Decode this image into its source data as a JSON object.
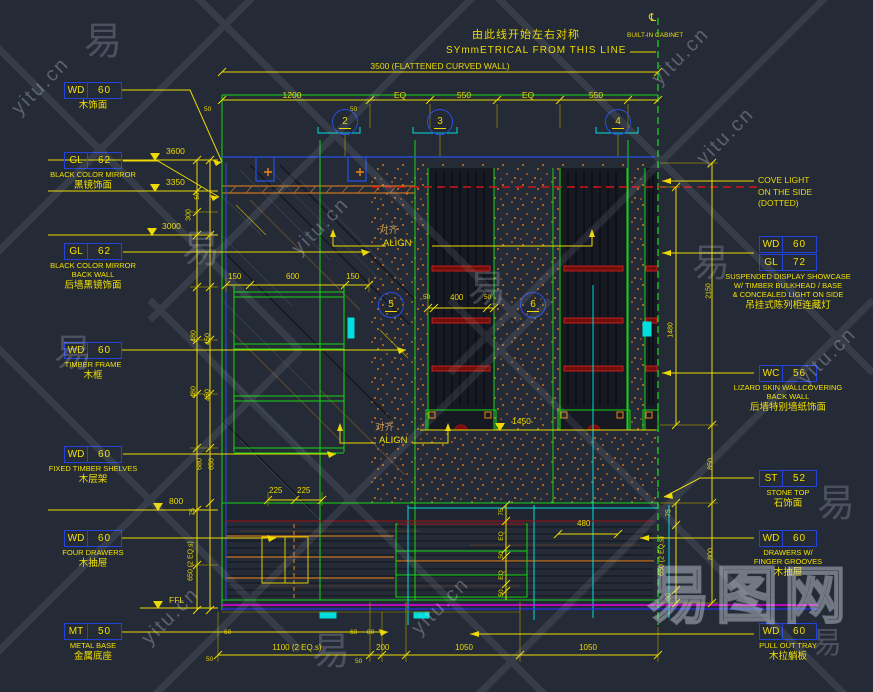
{
  "watermark": {
    "site": "yitu.cn",
    "brand": "易图网",
    "char": "易"
  },
  "header": {
    "title_cn": "由此线开始左右对称",
    "title_en": "SYmmETRICAL FROM THIS LINE",
    "corner_label": "BUILT-IN CABINET",
    "centerline_symbol": "℄",
    "overall_dim": "3500 (FLATTENED CURVED WALL)"
  },
  "bubbles": {
    "b2": "2",
    "b3": "3",
    "b4": "4",
    "b5": "5",
    "b6": "6"
  },
  "align": {
    "cn": "对齐",
    "en": "ALIGN"
  },
  "levels": {
    "l3600": "3600",
    "l3350": "3350",
    "l3000": "3000",
    "l1450": "1450",
    "l800": "800",
    "ffl": "FFL"
  },
  "dims": {
    "top": {
      "d1200": "1200",
      "eq1": "EQ",
      "d550a": "550",
      "eq2": "EQ",
      "d550b": "550",
      "d50a": "50",
      "d50b": "50"
    },
    "left": {
      "d50": "50",
      "d300": "300",
      "d480a": "480",
      "d450a": "450",
      "d480b": "480",
      "d450b": "450",
      "d680": "680",
      "d650": "650",
      "d75": "75",
      "d650eq": "650 (2 EQ.s)"
    },
    "right": {
      "d2150": "2150",
      "d1480": "1480",
      "d850": "850",
      "d800": "800",
      "d75": "75",
      "d650eq": "650 (2 EQ.s)",
      "d60": "60"
    },
    "inner": {
      "d150a": "150",
      "d600": "600",
      "d150b": "150",
      "d50a": "50",
      "d400": "400",
      "d50b": "50",
      "d225a": "225",
      "d225b": "225",
      "d480": "480",
      "d75": "75",
      "eq1": "EQ",
      "d50c": "50",
      "eq2": "EQ",
      "d50d": "50"
    },
    "bottom": {
      "d50a": "50",
      "d60a": "60",
      "d1100": "1100 (2 EQ.s)",
      "d60b": "60",
      "d80": "80",
      "d50b": "50",
      "d200": "200",
      "d1050a": "1050",
      "d1050b": "1050"
    }
  },
  "callouts_left": [
    {
      "code": "WD",
      "num": "60",
      "lines": [],
      "cn": "木饰面"
    },
    {
      "code": "GL",
      "num": "62",
      "lines": [
        "BLACK COLOR MIRROR"
      ],
      "cn": "黑镜饰面"
    },
    {
      "code": "GL",
      "num": "62",
      "lines": [
        "BLACK COLOR MIRROR",
        "BACK WALL"
      ],
      "cn": "后墙黑镜饰面"
    },
    {
      "code": "WD",
      "num": "60",
      "lines": [
        "TIMBER FRAME"
      ],
      "cn": "木框"
    },
    {
      "code": "WD",
      "num": "60",
      "lines": [
        "FIXED TIMBER SHELVES"
      ],
      "cn": "木层架"
    },
    {
      "code": "WD",
      "num": "60",
      "lines": [
        "FOUR DRAWERS"
      ],
      "cn": "木抽屉"
    },
    {
      "code": "MT",
      "num": "50",
      "lines": [
        "METAL BASE"
      ],
      "cn": "金属底座"
    }
  ],
  "callouts_right": {
    "cove": {
      "line1": "COVE LIGHT",
      "line2": "ON THE SIDE",
      "line3": "(DOTTED)"
    },
    "showcase": {
      "rows": [
        {
          "code": "WD",
          "num": "60"
        },
        {
          "code": "GL",
          "num": "72"
        }
      ],
      "line1": "SUSPENDED DISPLAY SHOWCASE",
      "line2": "W/ TIMBER BULKHEAD / BASE",
      "line3": "& CONCEALED LIGHT ON SIDE",
      "cn": "吊挂式陈列柜连藏灯"
    },
    "wallcovering": {
      "code": "WC",
      "num": "56",
      "line1": "LIZARD SKIN WALLCOVERING",
      "line2": "BACK WALL",
      "cn": "后墙特别墙纸饰面"
    },
    "stone": {
      "code": "ST",
      "num": "52",
      "line1": "STONE TOP",
      "cn": "石饰面"
    },
    "drawers": {
      "code": "WD",
      "num": "60",
      "line1": "DRAWERS W/",
      "line2": "FINGER GROOVES",
      "cn": "木抽屉"
    },
    "tray": {
      "code": "WD",
      "num": "60",
      "line1": "PULL OUT TRAY",
      "cn": "木拉躺板"
    }
  },
  "colors": {
    "yellow": "#ecda02",
    "green": "#12d812",
    "cyan": "#00dede",
    "blue": "#2a4fe0",
    "red": "#d11616",
    "magenta": "#e800e8",
    "orange": "#ef8418"
  }
}
